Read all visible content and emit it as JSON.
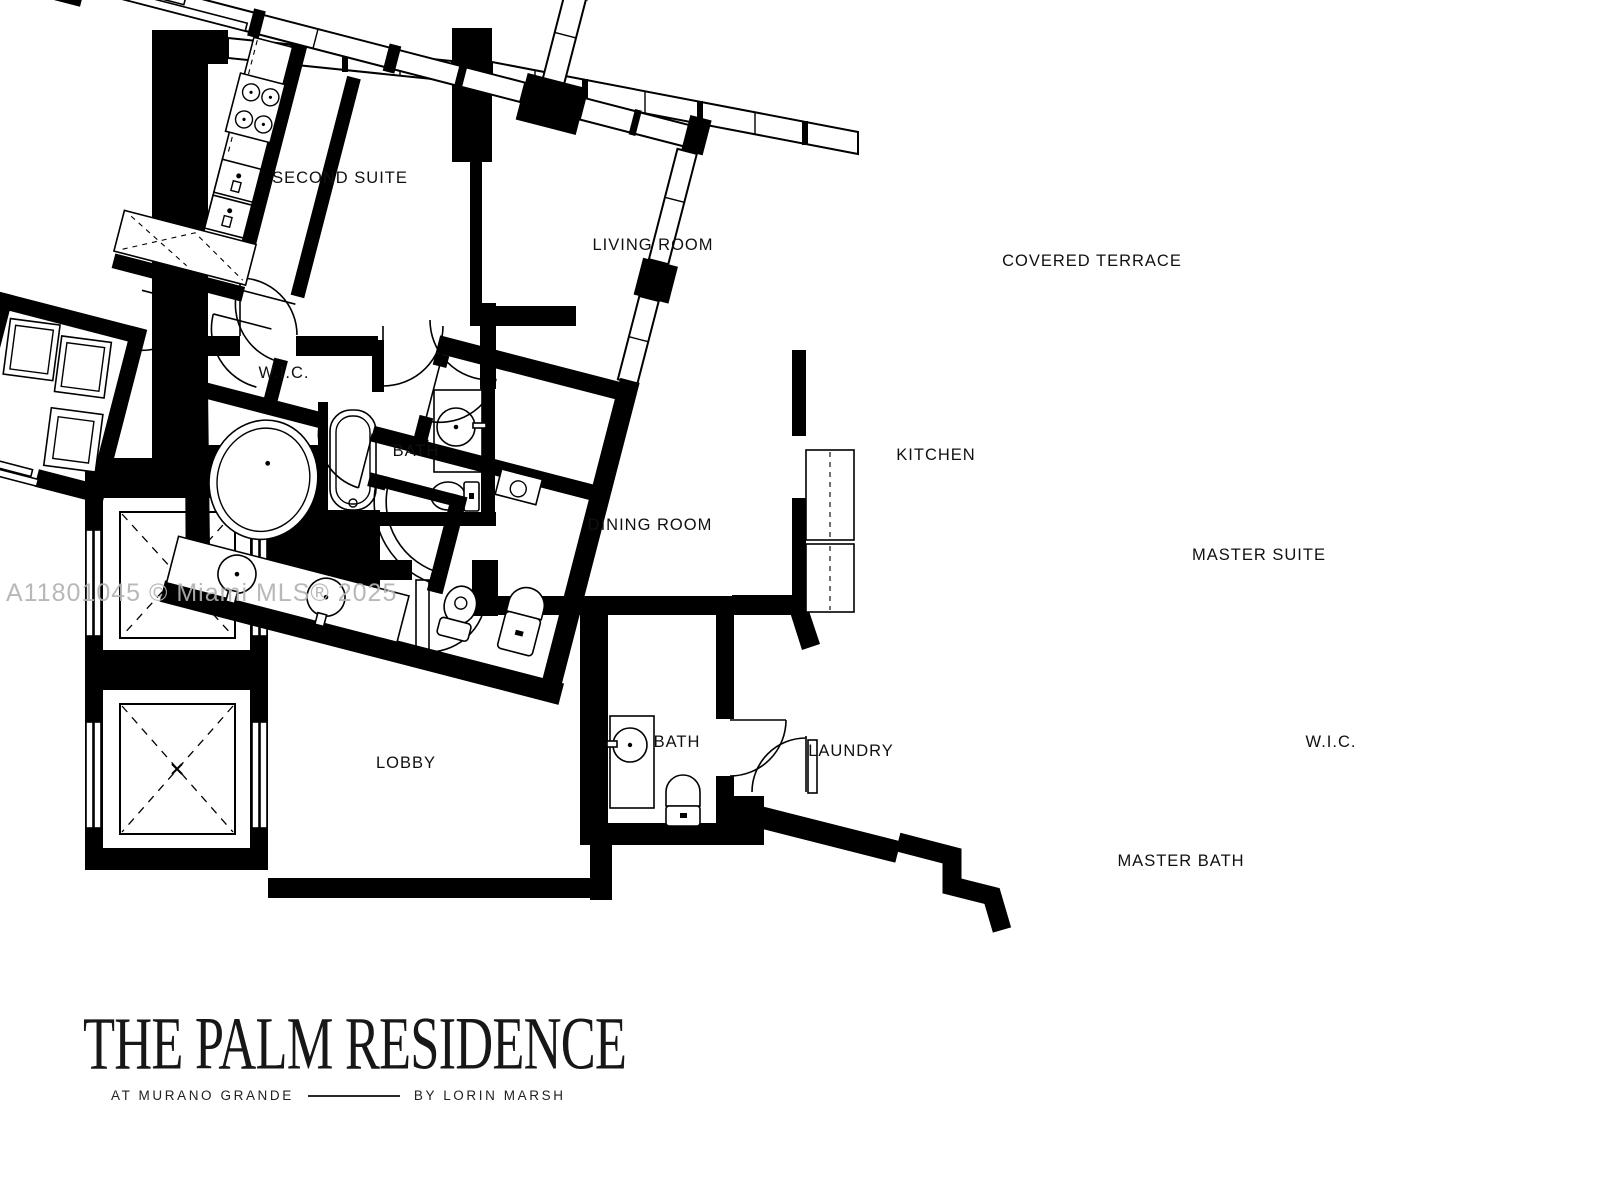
{
  "watermark": "A11801045 © Miami MLS® 2025",
  "title_block": {
    "title": "THE PALM RESIDENCE",
    "subtitle_left": "AT MURANO GRANDE",
    "subtitle_right": "BY LORIN MARSH"
  },
  "rooms": {
    "second_suite": "SECOND SUITE",
    "living_room": "LIVING ROOM",
    "covered_terrace": "COVERED TERRACE",
    "wic_second": "W.I.C.",
    "bath_second": "BATH",
    "kitchen": "KITCHEN",
    "dining_room": "DINING ROOM",
    "master_suite": "MASTER SUITE",
    "lobby": "LOBBY",
    "bath_powder": "BATH",
    "laundry": "LAUNDRY",
    "wic_master": "W.I.C.",
    "master_bath": "MASTER BATH"
  },
  "colors": {
    "walls": "#000000",
    "background": "#ffffff",
    "watermark": "#b2b2b2"
  }
}
